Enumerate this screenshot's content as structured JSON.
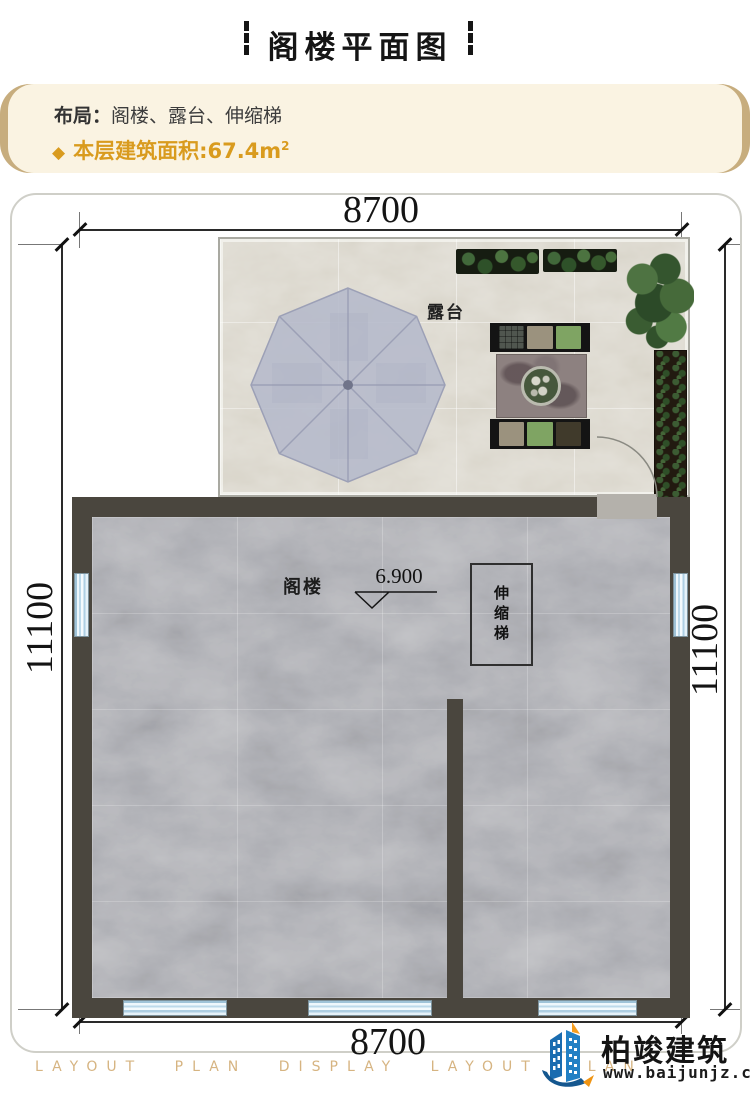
{
  "header": {
    "title": "阁楼平面图"
  },
  "info": {
    "layout_label": "布局：",
    "layout_value": "阁楼、露台、伸缩梯",
    "area_bullet": "◆",
    "area_text": "本层建筑面积:67.4m",
    "area_sup": "2"
  },
  "plan": {
    "dims": {
      "top": "8700",
      "bottom": "8700",
      "left": "11100",
      "right": "11100"
    },
    "labels": {
      "terrace": "露台",
      "attic": "阁楼",
      "elevation": "6.900",
      "ladder": "伸缩梯"
    }
  },
  "footer": {
    "watermark": "LAYOUT PLAN DISPLAY LAYOUT PLAN DISPLAY LAYOUT",
    "brand": "柏竣建筑",
    "url": "www.baijunjz.com"
  },
  "colors": {
    "accent_gold": "#d99b1e",
    "info_bg": "#faf3e2",
    "info_edge": "#c7ad7e",
    "wall": "#4a463e",
    "floor_marble": "#9c9da3",
    "terrace_stone": "#d8d4c9",
    "umbrella": "#b5b9cb",
    "window_blue": "#bcd9ea",
    "logo_blue": "#1a6cb0",
    "logo_orange": "#f59d1e"
  }
}
